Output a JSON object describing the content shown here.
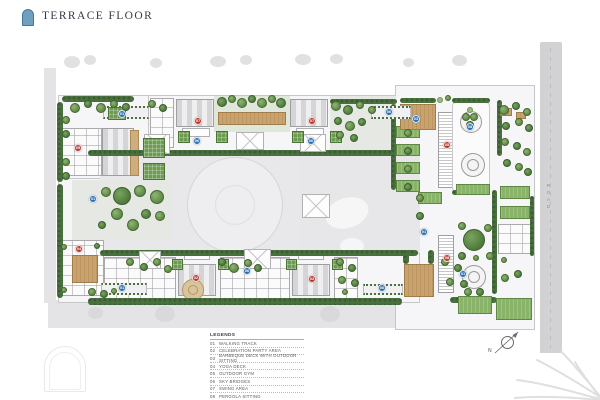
{
  "header": {
    "title": "TERRACE FLOOR"
  },
  "legend": {
    "header": "LEGENDS",
    "items": [
      {
        "no": "01",
        "label": "WALKING TRACK"
      },
      {
        "no": "02",
        "label": "CELEBRATION PARTY AREA"
      },
      {
        "no": "03",
        "label": "BARBEQUE DECK WITH OUTDOOR SITTING"
      },
      {
        "no": "04",
        "label": "YOGA DECK"
      },
      {
        "no": "05",
        "label": "OUTDOOR GYM"
      },
      {
        "no": "06",
        "label": "SKY BRIDGES"
      },
      {
        "no": "07",
        "label": "SWING AREA"
      },
      {
        "no": "08",
        "label": "PERGOLA SITTING"
      }
    ]
  },
  "road_label": "ROAD",
  "compass": {
    "label": "N"
  },
  "colors": {
    "accent_arch": "#6fa0c0",
    "marker_red": "#b63a30",
    "marker_blue": "#2d6fae",
    "hedge_green": "#4a7040",
    "deck_tan": "#c9a36f"
  },
  "plan": {
    "markers": [
      {
        "x": 122,
        "y": 114,
        "n": "01",
        "c": "blue"
      },
      {
        "x": 389,
        "y": 112,
        "n": "06",
        "c": "blue"
      },
      {
        "x": 198,
        "y": 121,
        "n": "07",
        "c": "red"
      },
      {
        "x": 312,
        "y": 121,
        "n": "07",
        "c": "red"
      },
      {
        "x": 197,
        "y": 141,
        "n": "06",
        "c": "blue"
      },
      {
        "x": 311,
        "y": 141,
        "n": "06",
        "c": "blue"
      },
      {
        "x": 78,
        "y": 148,
        "n": "05",
        "c": "red"
      },
      {
        "x": 416,
        "y": 119,
        "n": "03",
        "c": "blue"
      },
      {
        "x": 470,
        "y": 127,
        "n": "08",
        "c": "blue"
      },
      {
        "x": 93,
        "y": 199,
        "n": "01",
        "c": "blue"
      },
      {
        "x": 424,
        "y": 232,
        "n": "01",
        "c": "blue"
      },
      {
        "x": 447,
        "y": 145,
        "n": "05",
        "c": "red"
      },
      {
        "x": 79,
        "y": 249,
        "n": "04",
        "c": "red"
      },
      {
        "x": 122,
        "y": 288,
        "n": "01",
        "c": "blue"
      },
      {
        "x": 196,
        "y": 278,
        "n": "02",
        "c": "red"
      },
      {
        "x": 312,
        "y": 279,
        "n": "02",
        "c": "red"
      },
      {
        "x": 447,
        "y": 258,
        "n": "08",
        "c": "red"
      },
      {
        "x": 247,
        "y": 271,
        "n": "06",
        "c": "blue"
      },
      {
        "x": 382,
        "y": 288,
        "n": "06",
        "c": "blue"
      },
      {
        "x": 463,
        "y": 274,
        "n": "01",
        "c": "blue"
      }
    ],
    "hedges": [
      [
        62,
        96,
        72,
        6
      ],
      [
        57,
        102,
        6,
        80
      ],
      [
        57,
        184,
        6,
        114
      ],
      [
        88,
        298,
        314,
        7
      ],
      [
        88,
        150,
        330,
        6
      ],
      [
        100,
        250,
        318,
        6
      ],
      [
        391,
        104,
        5,
        86
      ],
      [
        400,
        98,
        36,
        5
      ],
      [
        452,
        98,
        38,
        5
      ],
      [
        452,
        190,
        38,
        5
      ],
      [
        497,
        100,
        5,
        56
      ],
      [
        492,
        190,
        5,
        104
      ],
      [
        403,
        250,
        6,
        14
      ],
      [
        428,
        250,
        6,
        14
      ],
      [
        450,
        297,
        47,
        6
      ],
      [
        330,
        99,
        67,
        5
      ],
      [
        530,
        196,
        4,
        60
      ]
    ],
    "lawns": [
      [
        396,
        126,
        24,
        12
      ],
      [
        396,
        144,
        24,
        12
      ],
      [
        396,
        162,
        24,
        12
      ],
      [
        396,
        180,
        24,
        12
      ],
      [
        418,
        192,
        24,
        12
      ],
      [
        456,
        184,
        34,
        11
      ],
      [
        458,
        296,
        34,
        18
      ],
      [
        496,
        298,
        36,
        22
      ],
      [
        500,
        186,
        30,
        13
      ],
      [
        500,
        206,
        30,
        13
      ]
    ],
    "decks": [
      [
        400,
        104,
        36,
        26
      ],
      [
        404,
        264,
        30,
        33
      ],
      [
        72,
        255,
        26,
        28
      ],
      [
        218,
        112,
        68,
        13
      ],
      [
        500,
        108,
        12,
        8
      ],
      [
        516,
        112,
        10,
        7
      ]
    ],
    "canopies": [
      [
        144,
        134,
        26,
        20
      ],
      [
        236,
        132,
        28,
        18
      ],
      [
        300,
        134,
        26,
        18
      ],
      [
        302,
        194,
        28,
        24
      ],
      [
        139,
        251,
        22,
        18
      ],
      [
        244,
        249,
        27,
        20
      ]
    ],
    "bridges": [
      [
        103,
        106,
        46,
        13
      ],
      [
        371,
        106,
        40,
        13
      ],
      [
        101,
        283,
        46,
        12
      ],
      [
        363,
        284,
        40,
        11
      ]
    ],
    "roof_gardens": [
      [
        143,
        138,
        22,
        20
      ],
      [
        143,
        163,
        22,
        17
      ],
      [
        108,
        107,
        18,
        13
      ],
      [
        178,
        131,
        12,
        12
      ],
      [
        216,
        131,
        12,
        12
      ],
      [
        292,
        131,
        12,
        12
      ],
      [
        330,
        131,
        12,
        12
      ],
      [
        172,
        259,
        11,
        11
      ],
      [
        218,
        259,
        11,
        11
      ],
      [
        286,
        259,
        11,
        11
      ],
      [
        332,
        259,
        11,
        11
      ]
    ],
    "trees": [
      [
        75,
        108,
        5,
        1
      ],
      [
        88,
        104,
        4,
        0
      ],
      [
        101,
        108,
        5,
        1
      ],
      [
        114,
        104,
        4,
        1
      ],
      [
        126,
        107,
        4,
        0
      ],
      [
        152,
        104,
        4,
        1
      ],
      [
        163,
        108,
        4,
        0
      ],
      [
        66,
        120,
        4,
        1
      ],
      [
        66,
        134,
        4,
        0
      ],
      [
        66,
        162,
        4,
        1
      ],
      [
        66,
        176,
        4,
        0
      ],
      [
        122,
        196,
        9,
        0
      ],
      [
        140,
        191,
        6,
        1
      ],
      [
        157,
        197,
        7,
        1
      ],
      [
        106,
        192,
        5,
        1
      ],
      [
        117,
        214,
        6,
        1
      ],
      [
        146,
        214,
        5,
        0
      ],
      [
        133,
        225,
        6,
        1
      ],
      [
        102,
        225,
        4,
        0
      ],
      [
        160,
        216,
        5,
        1
      ],
      [
        222,
        102,
        5,
        0
      ],
      [
        232,
        99,
        4,
        1
      ],
      [
        242,
        103,
        5,
        1
      ],
      [
        252,
        99,
        4,
        0
      ],
      [
        262,
        103,
        5,
        1
      ],
      [
        272,
        99,
        4,
        1
      ],
      [
        281,
        103,
        5,
        0
      ],
      [
        336,
        106,
        5,
        1
      ],
      [
        348,
        110,
        5,
        0
      ],
      [
        360,
        105,
        4,
        1
      ],
      [
        372,
        110,
        4,
        1
      ],
      [
        338,
        121,
        4,
        0
      ],
      [
        350,
        126,
        5,
        1
      ],
      [
        362,
        122,
        4,
        0
      ],
      [
        340,
        135,
        4,
        1
      ],
      [
        354,
        138,
        4,
        0
      ],
      [
        408,
        133,
        4,
        1
      ],
      [
        408,
        151,
        4,
        0
      ],
      [
        408,
        169,
        4,
        1
      ],
      [
        408,
        187,
        4,
        0
      ],
      [
        504,
        110,
        5,
        1
      ],
      [
        516,
        106,
        4,
        0
      ],
      [
        527,
        112,
        4,
        1
      ],
      [
        506,
        126,
        4,
        0
      ],
      [
        519,
        122,
        4,
        1
      ],
      [
        529,
        128,
        4,
        0
      ],
      [
        505,
        142,
        4,
        1
      ],
      [
        517,
        146,
        4,
        0
      ],
      [
        527,
        152,
        4,
        1
      ],
      [
        507,
        163,
        4,
        0
      ],
      [
        519,
        167,
        4,
        1
      ],
      [
        528,
        172,
        4,
        0
      ],
      [
        466,
        117,
        4,
        1
      ],
      [
        474,
        117,
        4,
        1
      ],
      [
        470,
        125,
        4,
        1
      ],
      [
        470,
        110,
        3,
        2
      ],
      [
        420,
        198,
        4,
        1
      ],
      [
        420,
        216,
        4,
        0
      ],
      [
        474,
        240,
        11,
        0
      ],
      [
        462,
        226,
        4,
        1
      ],
      [
        488,
        228,
        4,
        1
      ],
      [
        462,
        256,
        4,
        0
      ],
      [
        490,
        256,
        4,
        1
      ],
      [
        476,
        258,
        3,
        1
      ],
      [
        445,
        262,
        4,
        1
      ],
      [
        458,
        268,
        4,
        0
      ],
      [
        450,
        282,
        4,
        1
      ],
      [
        464,
        284,
        4,
        0
      ],
      [
        468,
        292,
        4,
        1
      ],
      [
        480,
        292,
        4,
        0
      ],
      [
        505,
        278,
        4,
        1
      ],
      [
        518,
        274,
        4,
        0
      ],
      [
        504,
        260,
        3,
        1
      ],
      [
        64,
        247,
        3,
        1
      ],
      [
        97,
        246,
        3,
        0
      ],
      [
        64,
        290,
        3,
        1
      ],
      [
        92,
        292,
        4,
        1
      ],
      [
        104,
        294,
        4,
        0
      ],
      [
        114,
        291,
        3,
        1
      ],
      [
        130,
        262,
        4,
        1
      ],
      [
        144,
        267,
        4,
        0
      ],
      [
        157,
        262,
        4,
        1
      ],
      [
        168,
        269,
        4,
        1
      ],
      [
        222,
        262,
        4,
        0
      ],
      [
        234,
        268,
        5,
        1
      ],
      [
        248,
        263,
        4,
        1
      ],
      [
        258,
        268,
        4,
        0
      ],
      [
        340,
        262,
        4,
        1
      ],
      [
        352,
        268,
        4,
        0
      ],
      [
        342,
        280,
        4,
        1
      ],
      [
        355,
        283,
        4,
        0
      ],
      [
        345,
        292,
        3,
        1
      ],
      [
        440,
        100,
        3,
        2
      ],
      [
        448,
        98,
        3,
        1
      ]
    ]
  }
}
